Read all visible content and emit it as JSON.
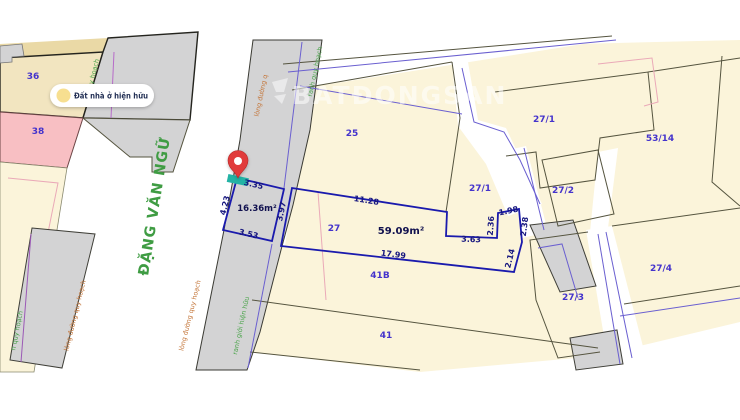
{
  "map": {
    "street": {
      "name": "ĐẶNG VĂN NGỮ"
    },
    "legend": {
      "label": "Đất nhà ở hiện hữu"
    },
    "watermark": "BATĐONGSAN",
    "highlight": {
      "small_lot": {
        "area": "16.36m²",
        "dims": {
          "top": "3.35",
          "left": "4.23",
          "bottom": "3.53",
          "right": "3.97"
        }
      },
      "main_lot": {
        "area": "59.09m²",
        "dims": {
          "top": "11.28",
          "bottom": "17.99",
          "inner": "3.63",
          "step_top": "1.98",
          "step_left": "2.36",
          "step_right": "2.38",
          "step_down": "2.14"
        }
      }
    },
    "parcels": {
      "p36": "36",
      "p38": "38",
      "p25": "25",
      "p27": "27",
      "p271a": "27/1",
      "p271b": "27/1",
      "p272": "27/2",
      "p5314": "53/14",
      "p274": "27/4",
      "p273": "27/3",
      "p41b": "41B",
      "p41": "41"
    },
    "annotations": {
      "a_quyhoach": "quy hoạch",
      "a_longduong_q": "lòng đường q",
      "a_ranh_quyhoach": "ranh quy hoạch",
      "a_n_quyhoach": "n quy hoạch",
      "a_longduong_1": "lòng đường quy hoạch",
      "a_longduong_2": "lòng đường quy hoạch",
      "a_ranhgioi": "ranh giới hiện hữu"
    },
    "colors": {
      "parcel_fill": "#fbf4da",
      "parcel_tan": "#f2e5c0",
      "parcel_pink": "#f8bfc3",
      "road_gray": "#d3d3d4",
      "lot_outline": "#1a1aad",
      "parcel_label": "#4433cc",
      "dim_label": "#17177f",
      "street_green": "#3f9c43",
      "annotation_orange": "#c4763a",
      "pin_red": "#e13b3b",
      "marker_teal": "#23b3a5",
      "legend_dot": "#f7df90"
    }
  }
}
